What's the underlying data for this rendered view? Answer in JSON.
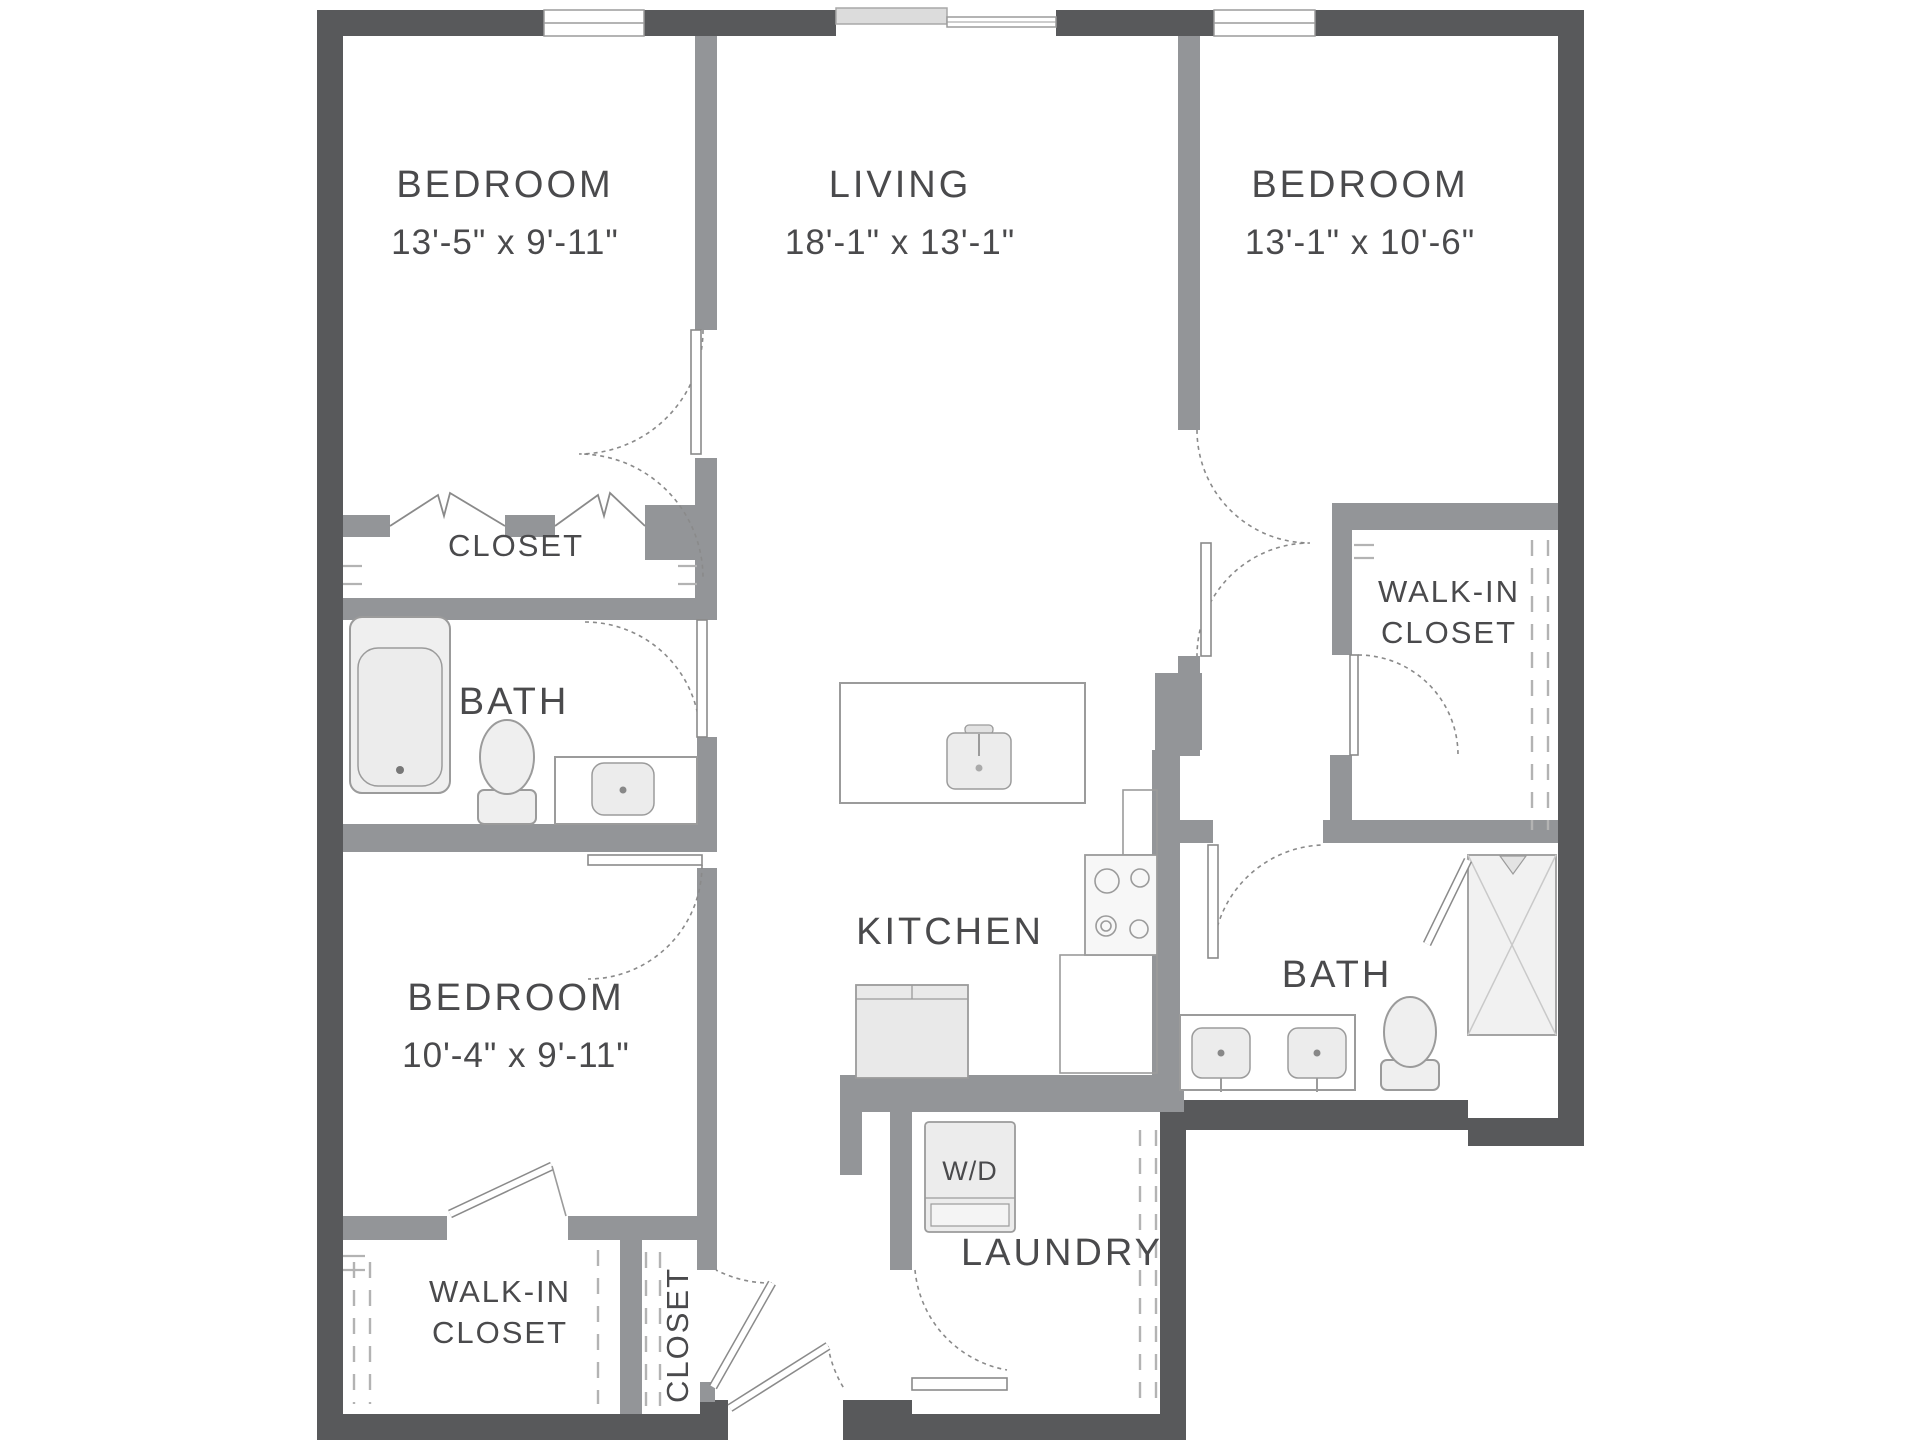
{
  "rooms": {
    "bedroom_top_left": {
      "name": "BEDROOM",
      "dims": "13'-5\" x 9'-11\""
    },
    "living": {
      "name": "LIVING",
      "dims": "18'-1\" x 13'-1\""
    },
    "bedroom_top_right": {
      "name": "BEDROOM",
      "dims": "13'-1\" x 10'-6\""
    },
    "bedroom_bottom": {
      "name": "BEDROOM",
      "dims": "10'-4\" x 9'-11\""
    },
    "closet_top": {
      "name": "CLOSET"
    },
    "bath_left": {
      "name": "BATH"
    },
    "bath_right": {
      "name": "BATH"
    },
    "kitchen": {
      "name": "KITCHEN"
    },
    "laundry": {
      "name": "LAUNDRY"
    },
    "walk_in_right": {
      "line1": "WALK-IN",
      "line2": "CLOSET"
    },
    "walk_in_left": {
      "line1": "WALK-IN",
      "line2": "CLOSET"
    },
    "closet_entry": {
      "name": "CLOSET"
    }
  },
  "laundry_unit": {
    "label": "W/D"
  },
  "colors": {
    "exterior": "#58595b",
    "interior": "#939598",
    "door_stroke": "#8a8a8a",
    "dash_color": "#b3b3b3",
    "fixture_stroke": "#9b9b9b",
    "fixture_fill": "#efefef",
    "text": "#4a4a4c"
  }
}
